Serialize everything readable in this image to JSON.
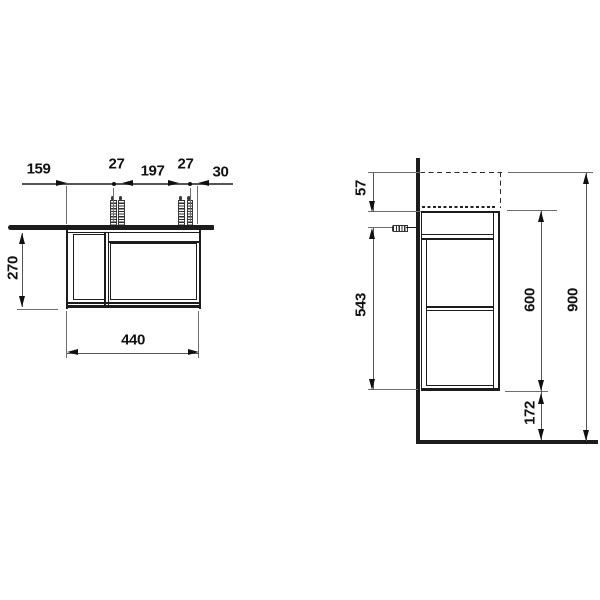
{
  "front": {
    "dims": {
      "offset_left": "159",
      "tap_pitch_left": "27",
      "tap_centers": "197",
      "tap_pitch_right": "27",
      "offset_right": "30",
      "depth": "270",
      "width": "440"
    }
  },
  "side": {
    "dims": {
      "rim_height": "57",
      "fixing_height": "543",
      "body_height": "600",
      "overall_height": "900",
      "floor_gap": "172"
    }
  },
  "colors": {
    "line": "#1c1c1c",
    "dim_line": "#555555",
    "background": "#ffffff"
  }
}
